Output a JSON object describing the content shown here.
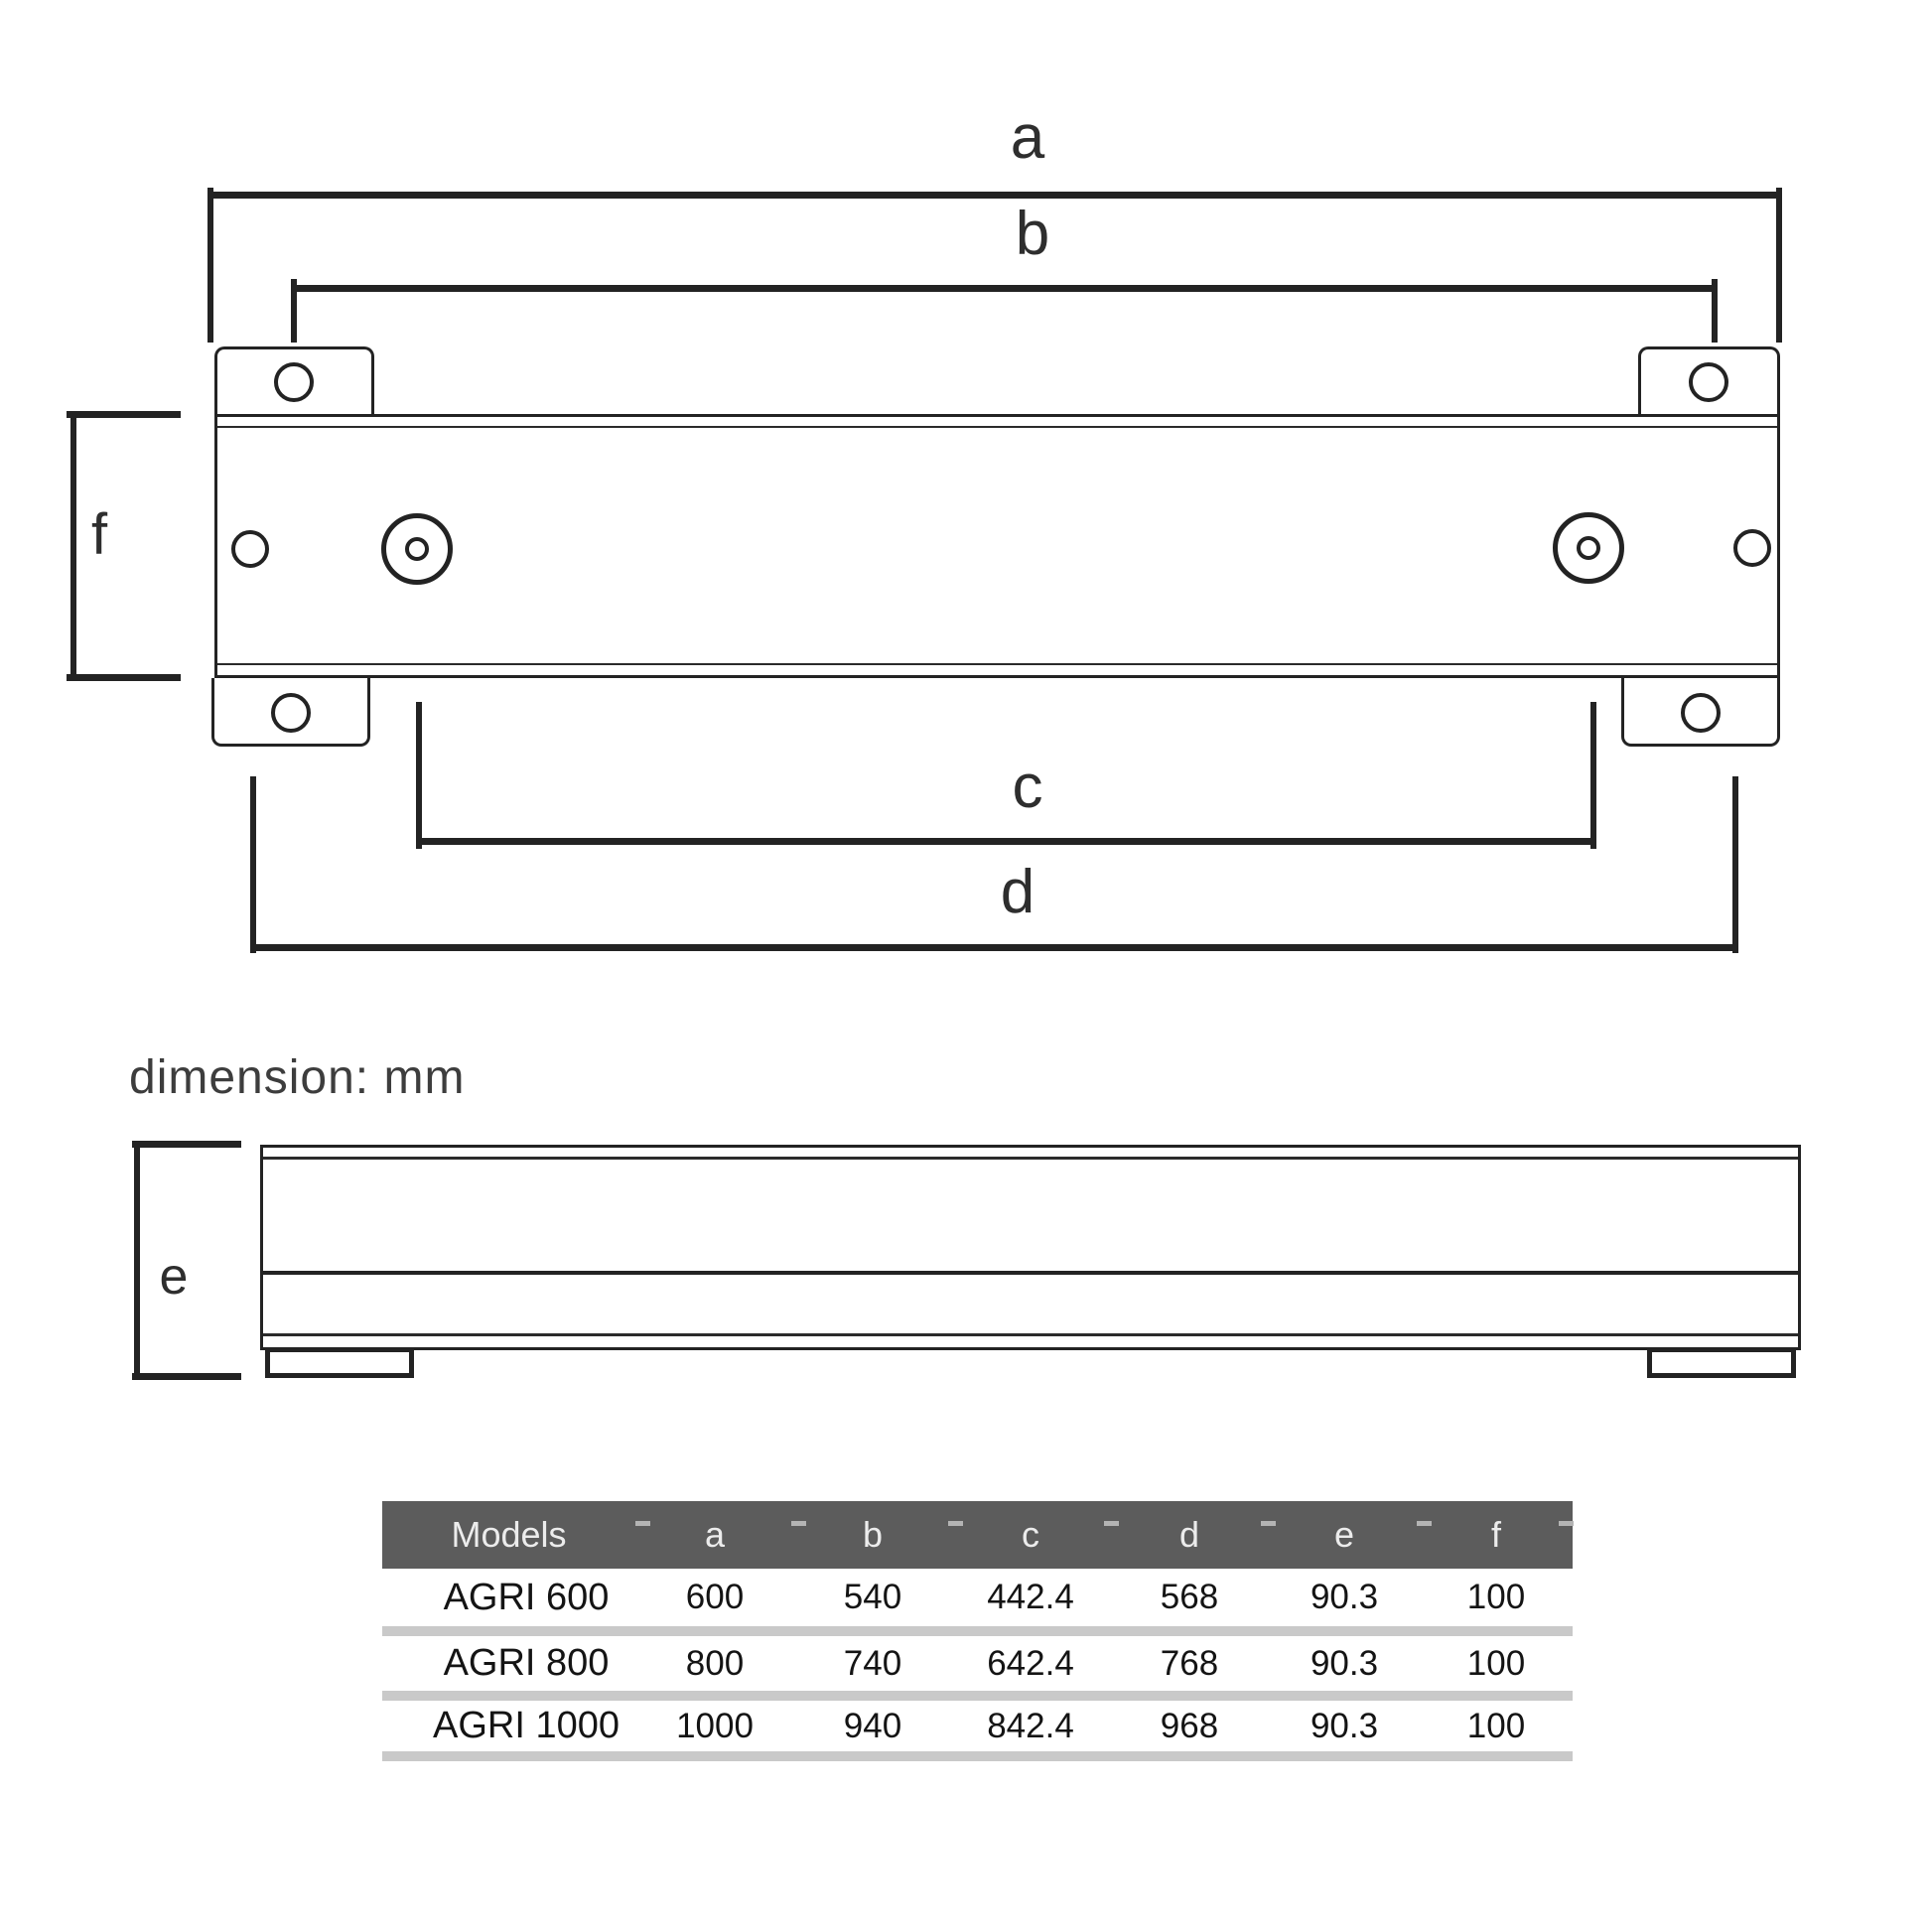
{
  "note": {
    "text": "dimension: mm"
  },
  "drawing": {
    "dim_labels": {
      "a": "a",
      "b": "b",
      "c": "c",
      "d": "d",
      "e": "e",
      "f": "f"
    }
  },
  "theme": {
    "ink": "#232323",
    "table_header_bg": "#5c5c5c",
    "table_header_text": "#ececec",
    "row_separator": "#c9c9c9"
  },
  "table": {
    "columns": [
      "Models",
      "a",
      "b",
      "c",
      "d",
      "e",
      "f"
    ],
    "rows": [
      [
        "AGRI 600",
        "600",
        "540",
        "442.4",
        "568",
        "90.3",
        "100"
      ],
      [
        "AGRI 800",
        "800",
        "740",
        "642.4",
        "768",
        "90.3",
        "100"
      ],
      [
        "AGRI 1000",
        "1000",
        "940",
        "842.4",
        "968",
        "90.3",
        "100"
      ]
    ]
  }
}
